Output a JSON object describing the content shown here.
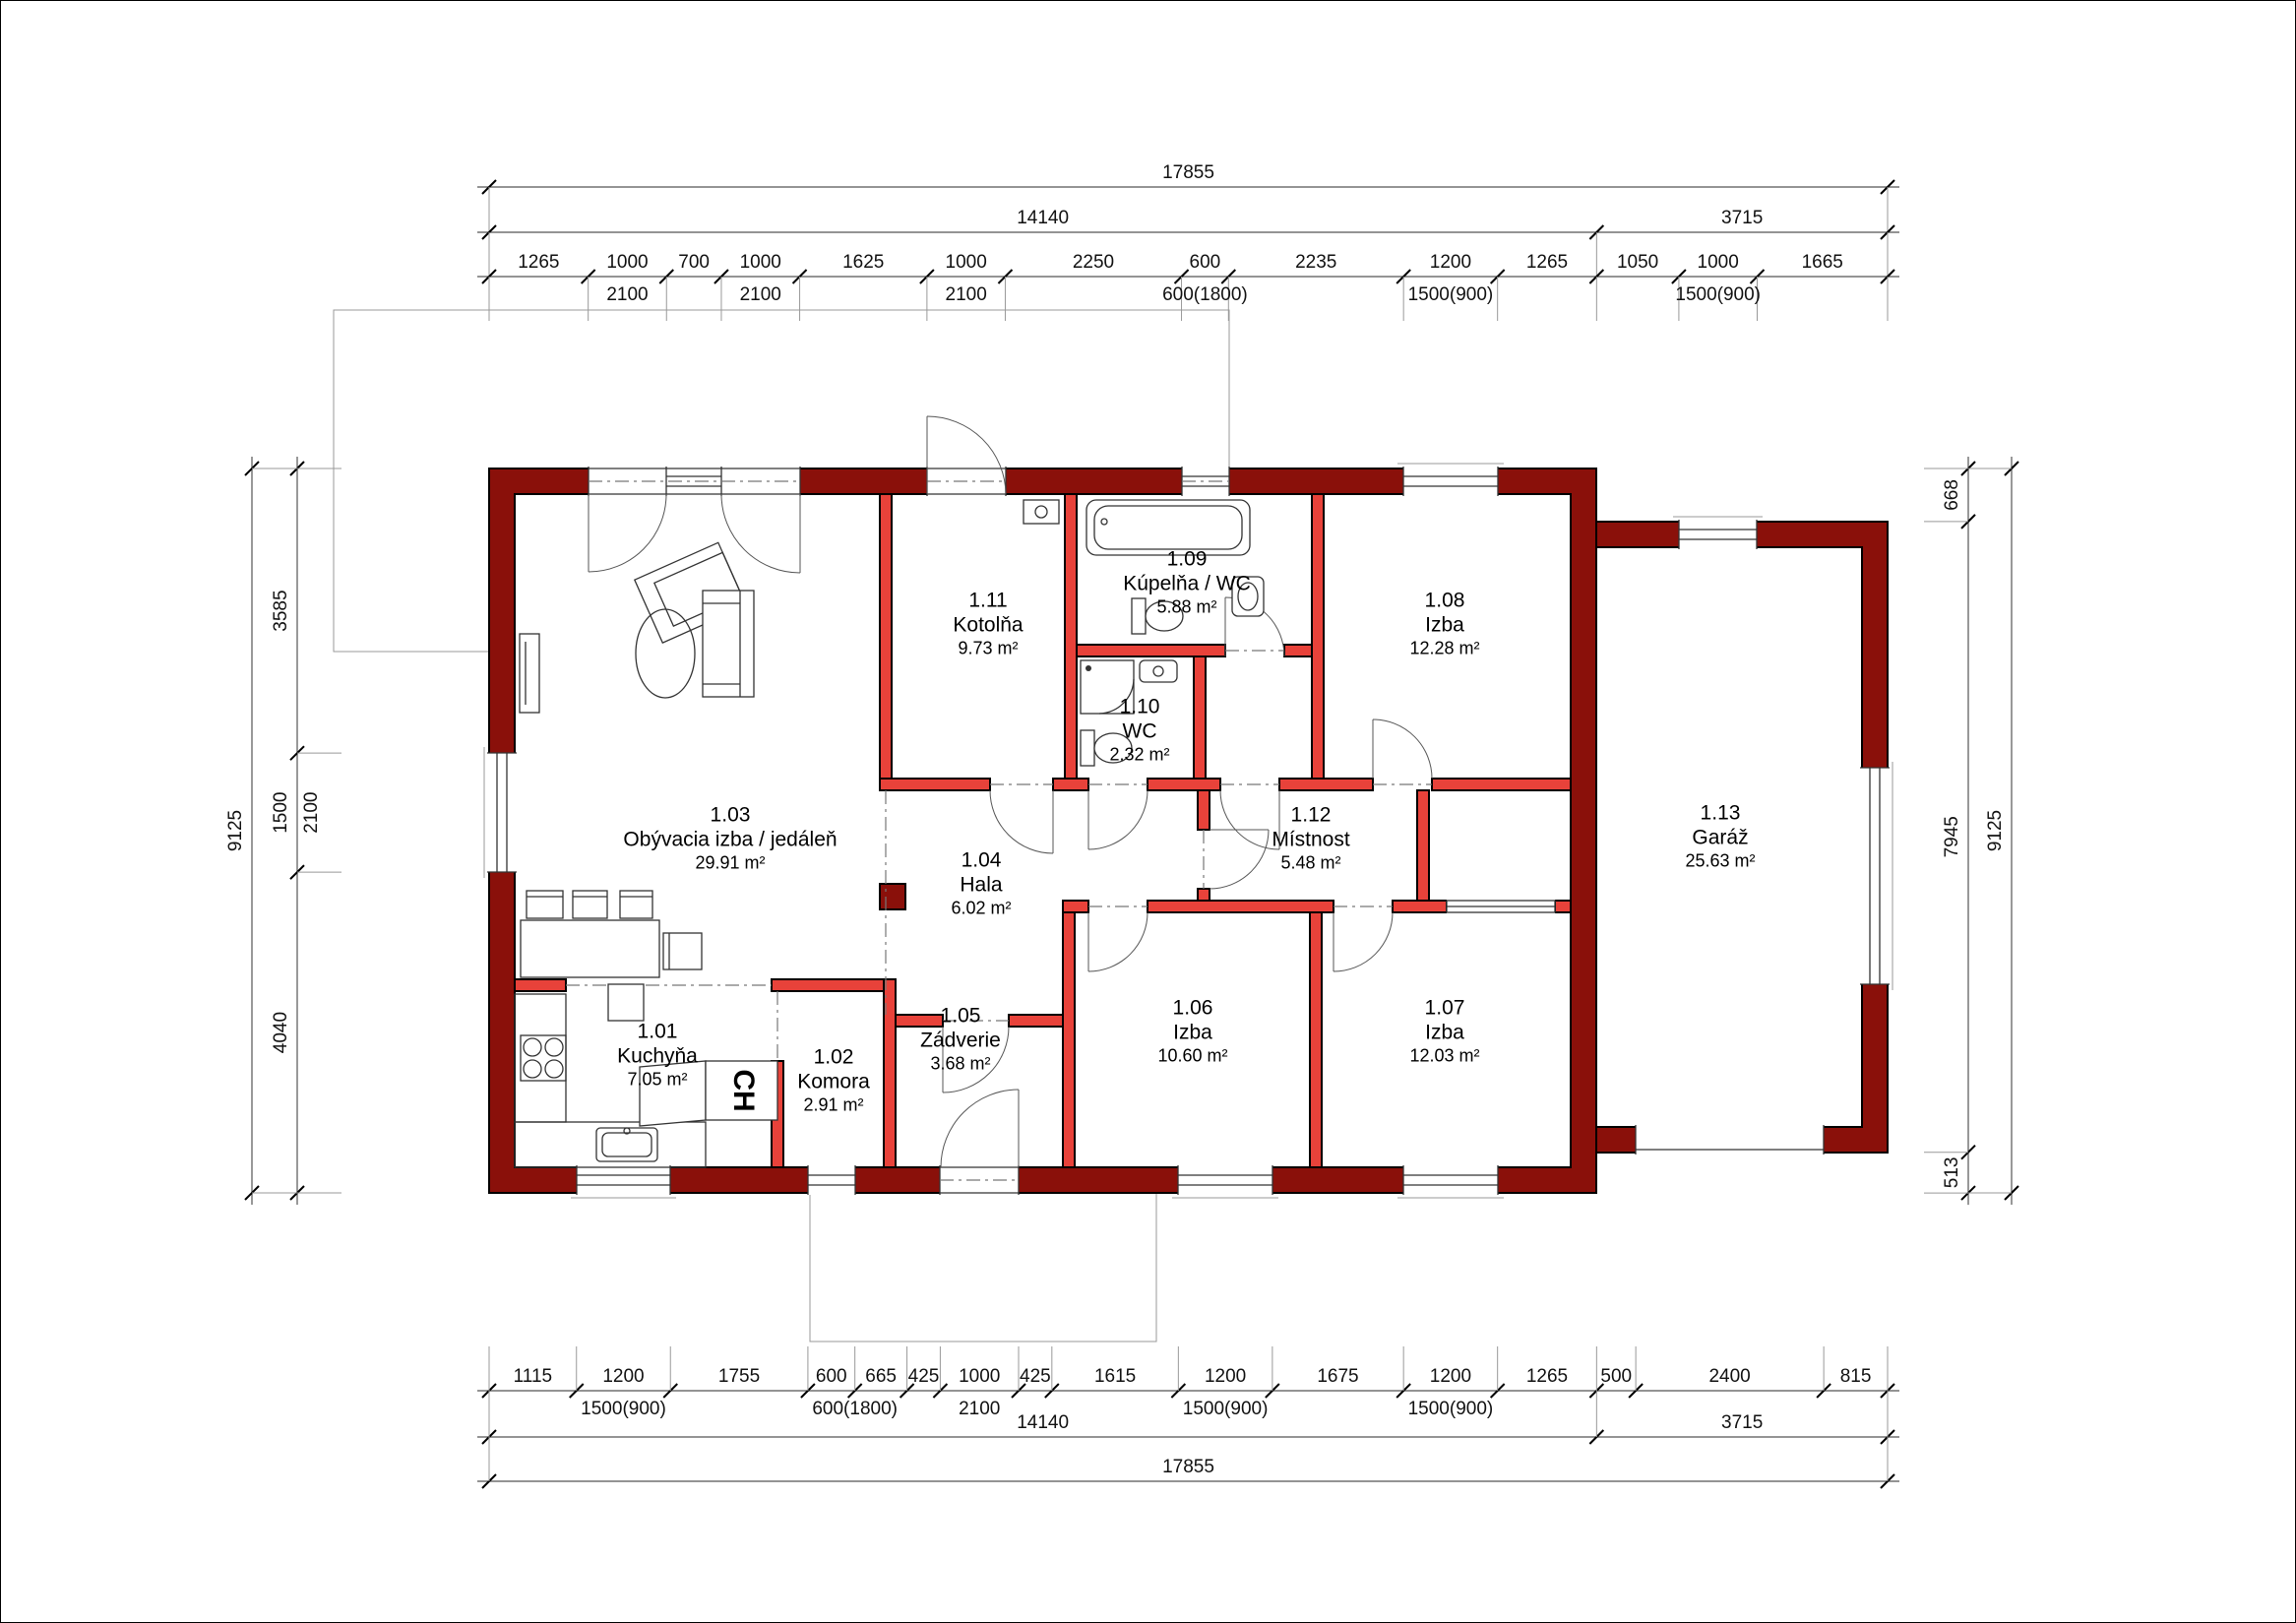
{
  "rooms": [
    {
      "number": "1.01",
      "name": "Kuchyňa",
      "area": "7.05 m²"
    },
    {
      "number": "1.02",
      "name": "Komora",
      "area": "2.91 m²"
    },
    {
      "number": "1.03",
      "name": "Obývacia izba / jedáleň",
      "area": "29.91 m²"
    },
    {
      "number": "1.04",
      "name": "Hala",
      "area": "6.02 m²"
    },
    {
      "number": "1.05",
      "name": "Zádverie",
      "area": "3.68 m²"
    },
    {
      "number": "1.06",
      "name": "Izba",
      "area": "10.60 m²"
    },
    {
      "number": "1.07",
      "name": "Izba",
      "area": "12.03 m²"
    },
    {
      "number": "1.08",
      "name": "Izba",
      "area": "12.28 m²"
    },
    {
      "number": "1.09",
      "name": "Kúpelňa / WC",
      "area": "5.88 m²"
    },
    {
      "number": "1.10",
      "name": "WC",
      "area": "2.32 m²"
    },
    {
      "number": "1.11",
      "name": "Kotolňa",
      "area": "9.73 m²"
    },
    {
      "number": "1.12",
      "name": "Místnost",
      "area": "5.48 m²"
    },
    {
      "number": "1.13",
      "name": "Garáž",
      "area": "25.63 m²"
    }
  ],
  "appliance_label": "CH",
  "colors": {
    "exterior_wall": "#8a100a",
    "interior_wall": "#e8423a"
  },
  "dimensions": {
    "top_rows": [
      {
        "segments": [
          {
            "v": 17855
          }
        ]
      },
      {
        "segments": [
          {
            "v": 14140
          },
          {
            "v": 3715
          }
        ]
      },
      {
        "segments": [
          {
            "v": 1265
          },
          {
            "v": 1000,
            "sub": "2100"
          },
          {
            "v": 700
          },
          {
            "v": 1000,
            "sub": "2100"
          },
          {
            "v": 1625
          },
          {
            "v": 1000,
            "sub": "2100"
          },
          {
            "v": 2250
          },
          {
            "v": 600,
            "sub": "600(1800)"
          },
          {
            "v": 2235
          },
          {
            "v": 1200,
            "sub": "1500(900)"
          },
          {
            "v": 1265
          },
          {
            "v": 1050
          },
          {
            "v": 1000,
            "sub": "1500(900)"
          },
          {
            "v": 1665
          }
        ]
      }
    ],
    "bottom_rows": [
      {
        "segments": [
          {
            "v": 1115
          },
          {
            "v": 1200,
            "sub": "1500(900)"
          },
          {
            "v": 1755
          },
          {
            "v": 600,
            "sub": "600(1800)",
            "sub_at": "tick"
          },
          {
            "v": 665
          },
          {
            "v": 425
          },
          {
            "v": 1000,
            "sub": "2100"
          },
          {
            "v": 425
          },
          {
            "v": 1615
          },
          {
            "v": 1200,
            "sub": "1500(900)"
          },
          {
            "v": 1675
          },
          {
            "v": 1200,
            "sub": "1500(900)"
          },
          {
            "v": 1265
          },
          {
            "v": 500
          },
          {
            "v": 2400
          },
          {
            "v": 815
          }
        ]
      },
      {
        "segments": [
          {
            "v": 14140
          },
          {
            "v": 3715
          }
        ]
      },
      {
        "segments": [
          {
            "v": 17855
          }
        ]
      }
    ],
    "left_rows": [
      {
        "segments": [
          {
            "v": 3585
          },
          {
            "v": 1500,
            "sub": "2100"
          },
          {
            "v": 4040
          }
        ]
      },
      {
        "segments": [
          {
            "v": 9125
          }
        ]
      }
    ],
    "right_rows": [
      {
        "segments": [
          {
            "v": 668
          },
          {
            "v": 7945
          },
          {
            "v": 513
          }
        ]
      },
      {
        "segments": [
          {
            "v": 9125
          }
        ]
      }
    ]
  }
}
